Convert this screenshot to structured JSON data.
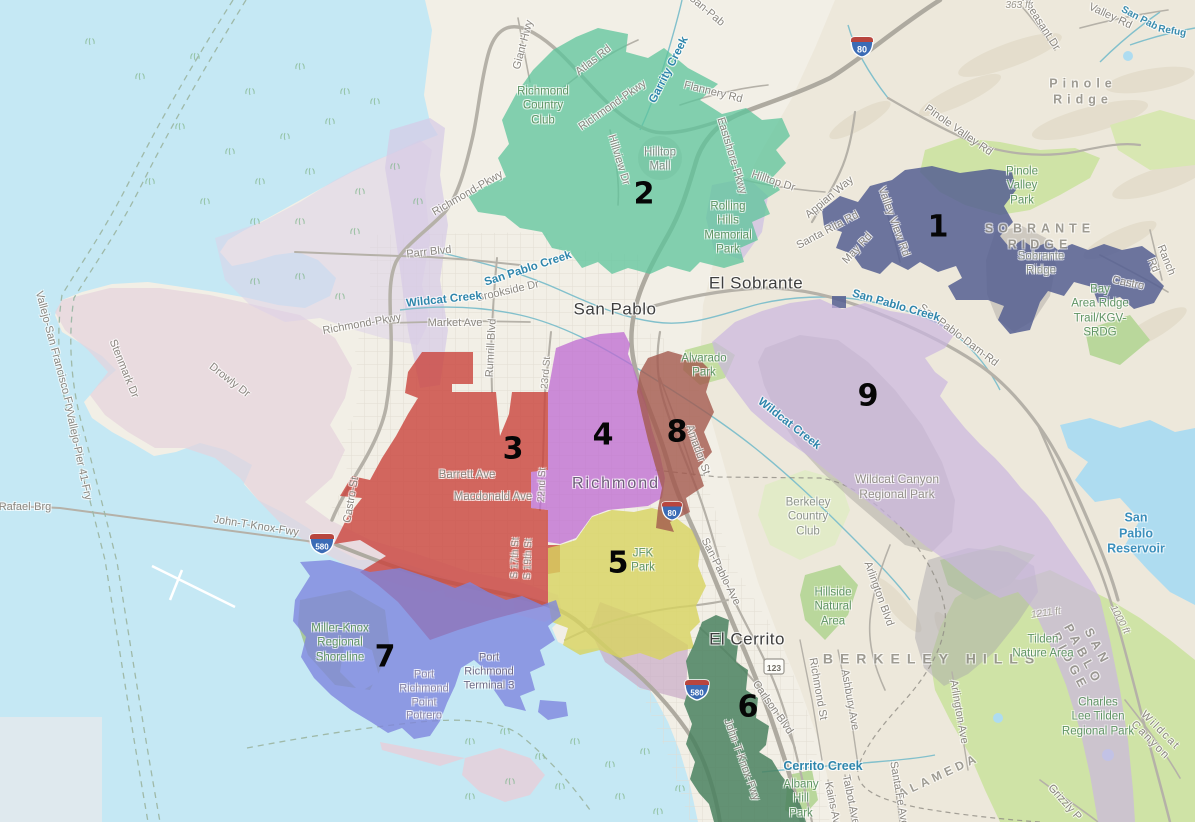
{
  "districts": [
    {
      "number": "1",
      "color": "#555F92"
    },
    {
      "number": "2",
      "color": "#5CC49B"
    },
    {
      "number": "3",
      "color": "#C9443C"
    },
    {
      "number": "4",
      "color": "#BE69D2"
    },
    {
      "number": "5",
      "color": "#D7D35F"
    },
    {
      "number": "6",
      "color": "#4A815F"
    },
    {
      "number": "7",
      "color": "#7E84DE"
    },
    {
      "number": "8",
      "color": "#A2594E"
    },
    {
      "number": "9",
      "color": "#CBB6E0"
    }
  ],
  "basemap_colors": {
    "water": "#c5e8f4",
    "land": "#f2efe6",
    "hills": "#eae4d3",
    "park_green": "#cfe3a6"
  },
  "cities": {
    "san_pablo": "San Pablo",
    "el_sobrante": "El Sobrante",
    "richmond": "Richmond",
    "el_cerrito": "El Cerrito"
  },
  "physical": {
    "pinole_ridge": "Pinole Ridge",
    "sobrante_ridge": "SOBRANTE RIDGE",
    "sobrante_ridge_small": "Sobrante\nRidge",
    "berkeley_hills": "BERKELEY HILLS",
    "san_pablo_ridge": "SAN PABLO RIDGE",
    "alameda": "ALAMEDA"
  },
  "parks": {
    "pinole_valley": "Pinole\nValley\nPark",
    "richmond_cc": "Richmond\nCountry\nClub",
    "rolling_hills": "Rolling\nHills\nMemorial\nPark",
    "alvarado": "Alvarado\nPark",
    "hillside": "Hillside\nNatural\nArea",
    "tilden_nature": "Tilden\nNature Area",
    "charles_tilden": "Charles\nLee Tilden\nRegional Park",
    "albany_hill": "Albany\nHill\nPark",
    "miller_knox": "Miller-Knox\nRegional\nShoreline",
    "jfk": "JFK\nPark",
    "bay_ridge_trail": "Bay\nArea Ridge\nTrail/KGV-\nSRDG",
    "berkeley_cc": "Berkeley\nCountry\nClub",
    "wildcat_canyon": "Wildcat Canyon\nRegional Park"
  },
  "places": {
    "hilltop_mall": "Hilltop\nMall",
    "port_richmond": "Port\nRichmond\nPoint\nPotrero",
    "port_terminal": "Port\nRichmond\nTerminal 3"
  },
  "roads": {
    "richmond_pkwy": "Richmond-Pkwy",
    "parr_blvd": "Parr Blvd",
    "market_ave": "Market Ave",
    "rumrill_blvd": "Rumrill Blvd",
    "brookside_dr": "Brookside Dr",
    "atlas_rd": "Atlas Rd",
    "giant_hwy": "Giant Hwy",
    "flannery_rd": "Flannery Rd",
    "eastshore_pkwy": "Eastshore-Pkwy",
    "hillview_dr": "Hillview Dr",
    "hilltop_dr": "Hilltop Dr",
    "appian_way": "Appian Way",
    "santa_rita_rd": "Santa Rita Rd",
    "may_rd": "May Rd",
    "valley_view_rd": "Valley View Rd",
    "pinole_valley_rd": "Pinole Valley Rd",
    "pheasant_dr": "Pheasant Dr",
    "valley_rd": "Valley Rd",
    "san_pab_partial": "San-Pab",
    "castro": "Castro",
    "ranch_rd": "Ranch Rd",
    "san_pablo_dam_rd": "San-Pablo-Dam-Rd",
    "san_pablo_ave": "San-Pablo-Ave",
    "amador_st": "Amador St",
    "castro_st": "Castro-St",
    "stenmark_dr": "Stenmark Dr",
    "drowly_dr": "Drowly Dr",
    "john_t_knox_fwy": "John-T-Knox-Fwy",
    "carlson_blvd": "Carlson Blvd",
    "richmond_st": "Richmond St",
    "ashbury_ave": "Ashbury Ave",
    "arlington_blvd": "Arlington Blvd",
    "arlington_ave": "Arlington Ave",
    "talbot_ave": "Talbot Ave",
    "kains_ave": "Kains Ave",
    "santa_fe_ave": "Santa Fe Ave",
    "grizzly": "Grizzly P",
    "wildcat_canyon_rd": "Wildcat Canyon",
    "barrett_ave": "Barrett Ave",
    "macdonald_ave": "Macdonald Ave",
    "s17th": "S 17th St",
    "s19th": "S 19th St",
    "st22": "22nd St",
    "st23": "23rd St",
    "rafael_brg": "Rafael-Brg"
  },
  "ferries": {
    "vallejo_sf": "Vallejo-San Francisco Fry",
    "vallejo_pier41": "Vallejo-Pier 41-Fry"
  },
  "creeks": {
    "san_pablo_creek": "San Pablo Creek",
    "wildcat_creek": "Wildcat Creek",
    "garrity_creek": "Garrity Creek",
    "cerrito_creek": "Cerrito Creek",
    "refugio": "Refug",
    "san_pab": "San Pab"
  },
  "water": {
    "san_pablo_reservoir": "San Pablo\nReservoir"
  },
  "elevations": {
    "e363": "363 ft",
    "e1211": "1211 ft",
    "e1000": "1000 ft"
  },
  "shields": {
    "i80": "80",
    "i580": "580",
    "ca123": "123"
  }
}
